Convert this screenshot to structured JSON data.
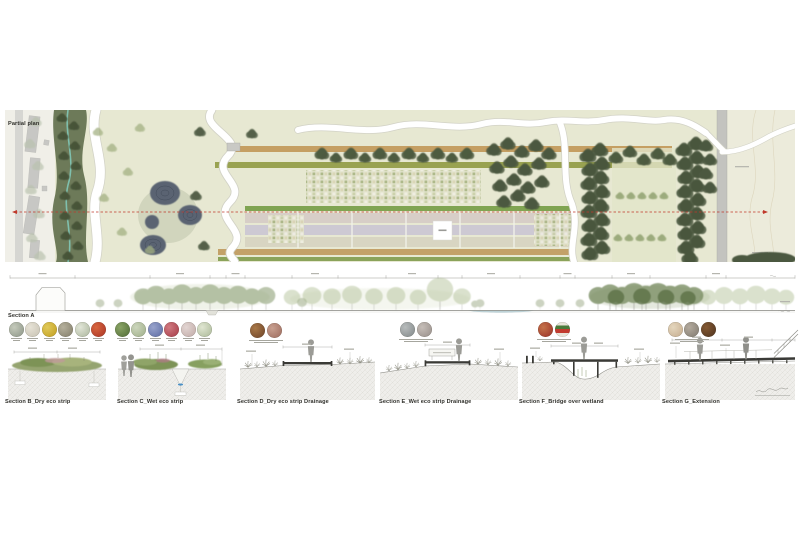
{
  "colors": {
    "field": "#e7e8d2",
    "field_right": "#ecebdb",
    "margin": "#f0efe8",
    "road": "#c3c3bf",
    "street": "#d6d6d2",
    "building": "#c7c7c4",
    "corridor": "#5f6e4b",
    "tree_dark": "#49563d",
    "tree_mid": "#4e5b40",
    "tree_light": "#9cab7d",
    "stream": "#7fc0ae",
    "pond": "#5a6472",
    "pond_ring": "#434c5a",
    "path_white": "#ffffff",
    "path_edge": "#d2d2c6",
    "red_line": "#c0392b",
    "soil": "#efeeeb",
    "deck": "#3a3a36",
    "figure": "#9b9b96",
    "water": "#4a90c6",
    "veg_green": "#7d9356",
    "veg_light": "#a7b37c",
    "elev_green": "#8ea077",
    "elev_pale": "#b6c39c",
    "elev_dark": "#75895c"
  },
  "plan": {
    "label": "Partial plan",
    "strips": [
      {
        "x": 228,
        "y": 146,
        "w": 444,
        "h": 6,
        "c": "#c59f63"
      },
      {
        "x": 215,
        "y": 162,
        "w": 457,
        "h": 6,
        "c": "#99a251"
      },
      {
        "x": 245,
        "y": 206,
        "w": 330,
        "h": 5,
        "c": "#80a452"
      },
      {
        "x": 245,
        "y": 213,
        "w": 330,
        "h": 10,
        "c": "#d7cec7"
      },
      {
        "x": 245,
        "y": 225,
        "w": 330,
        "h": 10,
        "c": "#cdc9d3"
      },
      {
        "x": 245,
        "y": 237,
        "w": 330,
        "h": 10,
        "c": "#d8d5c2"
      },
      {
        "x": 218,
        "y": 249,
        "w": 357,
        "h": 6,
        "c": "#c3a168"
      },
      {
        "x": 218,
        "y": 257,
        "w": 357,
        "h": 4,
        "c": "#8ba35a"
      }
    ]
  },
  "scalebar": {
    "ticks": [
      10,
      75,
      150,
      210,
      226,
      245,
      292,
      338,
      386,
      438,
      462,
      520,
      560,
      575,
      612,
      650,
      706,
      726,
      795
    ]
  },
  "long_section": {
    "label": "Section A"
  },
  "sections": [
    {
      "title": "Section B_Dry eco strip",
      "swatches": [
        {
          "name": "dry-grass",
          "c": "#9aa294",
          "c2": "#c5cabb"
        },
        {
          "name": "pale-bloom",
          "c": "#cfcabb",
          "c2": "#e6e2d6"
        },
        {
          "name": "yellow-bloom",
          "c": "#c9a92e",
          "c2": "#e0c95a"
        },
        {
          "name": "seed-head",
          "c": "#8f8a76",
          "c2": "#b5b09c"
        },
        {
          "name": "daisy",
          "c": "#b9c2ab",
          "c2": "#e2e6d8"
        },
        {
          "name": "poppy",
          "c": "#b5402c",
          "c2": "#d8663f"
        }
      ]
    },
    {
      "title": "Section C_Wet eco strip",
      "swatches": [
        {
          "name": "wet-grass",
          "c": "#5f7a42",
          "c2": "#8aa465"
        },
        {
          "name": "meadow-mix",
          "c": "#aab896",
          "c2": "#ccd6bc"
        },
        {
          "name": "blue-bloom",
          "c": "#6b79ad",
          "c2": "#98a3cc"
        },
        {
          "name": "red-bloom",
          "c": "#b04a55",
          "c2": "#d07a80"
        },
        {
          "name": "pink-bloom",
          "c": "#c9b5b2",
          "c2": "#e2d5d2"
        },
        {
          "name": "white-bloom",
          "c": "#b8c4a6",
          "c2": "#e0e6d2"
        }
      ]
    },
    {
      "title": "Section D_Dry eco strip Drainage",
      "swatches": [
        {
          "name": "mulch",
          "c": "#7c5030",
          "c2": "#a87848"
        },
        {
          "name": "gravel-pink",
          "c": "#a8786a",
          "c2": "#c8a090"
        }
      ]
    },
    {
      "title": "Section E_Wet eco strip Drainage",
      "swatches": [
        {
          "name": "gravel-grey",
          "c": "#8f9596",
          "c2": "#b8bcbc"
        },
        {
          "name": "gravel-mix",
          "c": "#a39a95",
          "c2": "#c6beb8"
        }
      ]
    },
    {
      "title": "Section F_Bridge over wetland",
      "swatches": [
        {
          "name": "planting-mix",
          "c": "#a5402f",
          "c2": "#c4724a"
        },
        {
          "name": "layer-diagram",
          "stripes": [
            "#e8e4d8",
            "#4a7a3a",
            "#c23b2e",
            "#e8e4d8"
          ]
        }
      ]
    },
    {
      "title": "Section G_Extension",
      "swatches": [
        {
          "name": "timber-pale",
          "c": "#cdb79a",
          "c2": "#e4d6bd"
        },
        {
          "name": "timber-grey",
          "c": "#8e877c",
          "c2": "#b3aa9d"
        },
        {
          "name": "timber-dark",
          "c": "#5c3d24",
          "c2": "#845932"
        }
      ]
    }
  ]
}
